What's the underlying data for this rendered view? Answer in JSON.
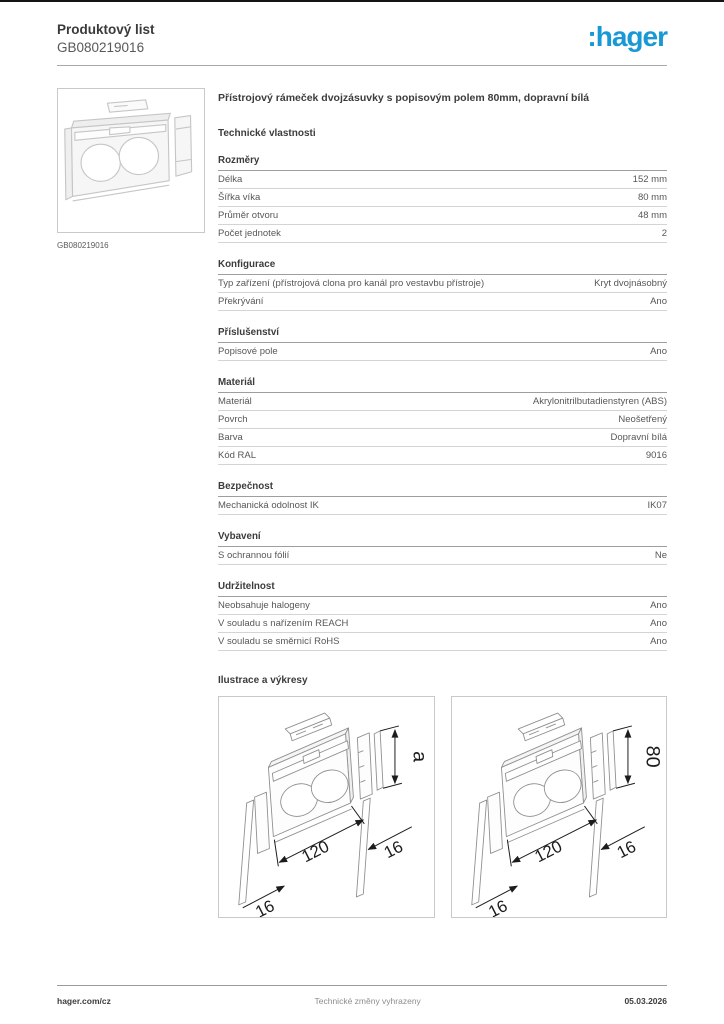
{
  "header": {
    "doc_type": "Produktový list",
    "product_id": "GB080219016",
    "logo_text": ":hager"
  },
  "colors": {
    "brand_blue": "#1898d4",
    "text_dark": "#3c3c3c",
    "rule_gray": "#a9a9a9",
    "row_line_gray": "#d4d4d4"
  },
  "product": {
    "image_caption": "GB080219016",
    "title": "Přístrojový rámeček dvojzásuvky s popisovým polem 80mm, dopravní bílá"
  },
  "tech_heading": "Technické vlastnosti",
  "sections": [
    {
      "title": "Rozměry",
      "rows": [
        {
          "label": "Délka",
          "value": "152 mm"
        },
        {
          "label": "Šířka víka",
          "value": "80 mm"
        },
        {
          "label": "Průměr otvoru",
          "value": "48 mm"
        },
        {
          "label": "Počet jednotek",
          "value": "2"
        }
      ]
    },
    {
      "title": "Konfigurace",
      "rows": [
        {
          "label": "Typ zařízení (přístrojová clona pro kanál pro vestavbu přístroje)",
          "value": "Kryt dvojnásobný"
        },
        {
          "label": "Překrývání",
          "value": "Ano"
        }
      ]
    },
    {
      "title": "Příslušenství",
      "rows": [
        {
          "label": "Popisové pole",
          "value": "Ano"
        }
      ]
    },
    {
      "title": "Materiál",
      "rows": [
        {
          "label": "Materiál",
          "value": "Akrylonitrilbutadienstyren (ABS)"
        },
        {
          "label": "Povrch",
          "value": "Neošetřený"
        },
        {
          "label": "Barva",
          "value": "Dopravní bílá"
        },
        {
          "label": "Kód RAL",
          "value": "9016"
        }
      ]
    },
    {
      "title": "Bezpečnost",
      "rows": [
        {
          "label": "Mechanická odolnost IK",
          "value": "IK07"
        }
      ]
    },
    {
      "title": "Vybavení",
      "rows": [
        {
          "label": "S ochrannou fólií",
          "value": "Ne"
        }
      ]
    },
    {
      "title": "Udržitelnost",
      "rows": [
        {
          "label": "Neobsahuje halogeny",
          "value": "Ano"
        },
        {
          "label": "V souladu s nařízením REACH",
          "value": "Ano"
        },
        {
          "label": "V souladu se směrnicí RoHS",
          "value": "Ano"
        }
      ]
    }
  ],
  "illustrations": {
    "heading": "Ilustrace a výkresy",
    "drawings": [
      {
        "width_label": "120",
        "depth_label": "16",
        "side_label": "16",
        "height_label": "a"
      },
      {
        "width_label": "120",
        "depth_label": "16",
        "side_label": "16",
        "height_label": "80"
      }
    ]
  },
  "footer": {
    "left": "hager.com/cz",
    "center": "Technické změny vyhrazeny",
    "right": "05.03.2026"
  }
}
